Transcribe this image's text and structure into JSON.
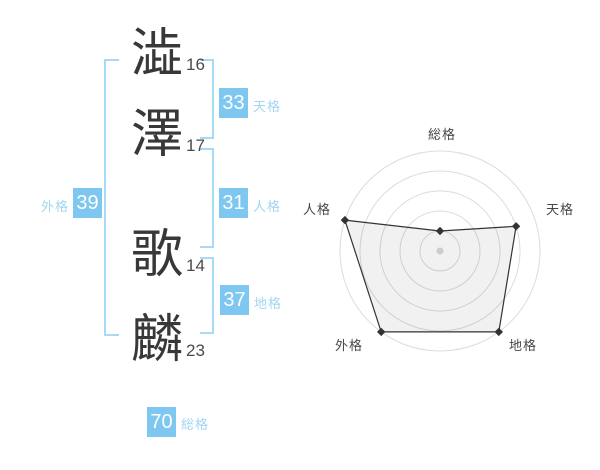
{
  "name_diagram": {
    "characters": [
      {
        "char": "澁",
        "strokes": "16"
      },
      {
        "char": "澤",
        "strokes": "17"
      },
      {
        "char": "歌",
        "strokes": "14"
      },
      {
        "char": "麟",
        "strokes": "23"
      }
    ],
    "badges": {
      "tenkaku": {
        "value": "33",
        "label": "天格"
      },
      "jinkaku": {
        "value": "31",
        "label": "人格"
      },
      "gaikaku": {
        "value": "39",
        "label": "外格"
      },
      "chikaku": {
        "value": "37",
        "label": "地格"
      },
      "soukaku": {
        "value": "70",
        "label": "総格"
      }
    }
  },
  "colors": {
    "badge_blue": "#7dc7f1",
    "label_blue": "#a2d5f2",
    "bracket_blue": "#a6daf7",
    "kanji_dark": "#383838",
    "grid_gray": "#dcdcdc",
    "polygon_line": "#333333",
    "polygon_fill": "rgba(0,0,0,0.055)",
    "center_dot": "#cccccc"
  },
  "chart_data": {
    "type": "radar",
    "axes": [
      "総格",
      "天格",
      "地格",
      "外格",
      "人格"
    ],
    "values": [
      1,
      4,
      5,
      5,
      5
    ],
    "max": 5,
    "rings": 5,
    "start_angle_deg": -90,
    "direction": "clockwise",
    "center": {
      "x": 440,
      "y": 251
    },
    "outer_radius": 100,
    "grid": "concentric-circles",
    "legend": "none",
    "title": ""
  }
}
